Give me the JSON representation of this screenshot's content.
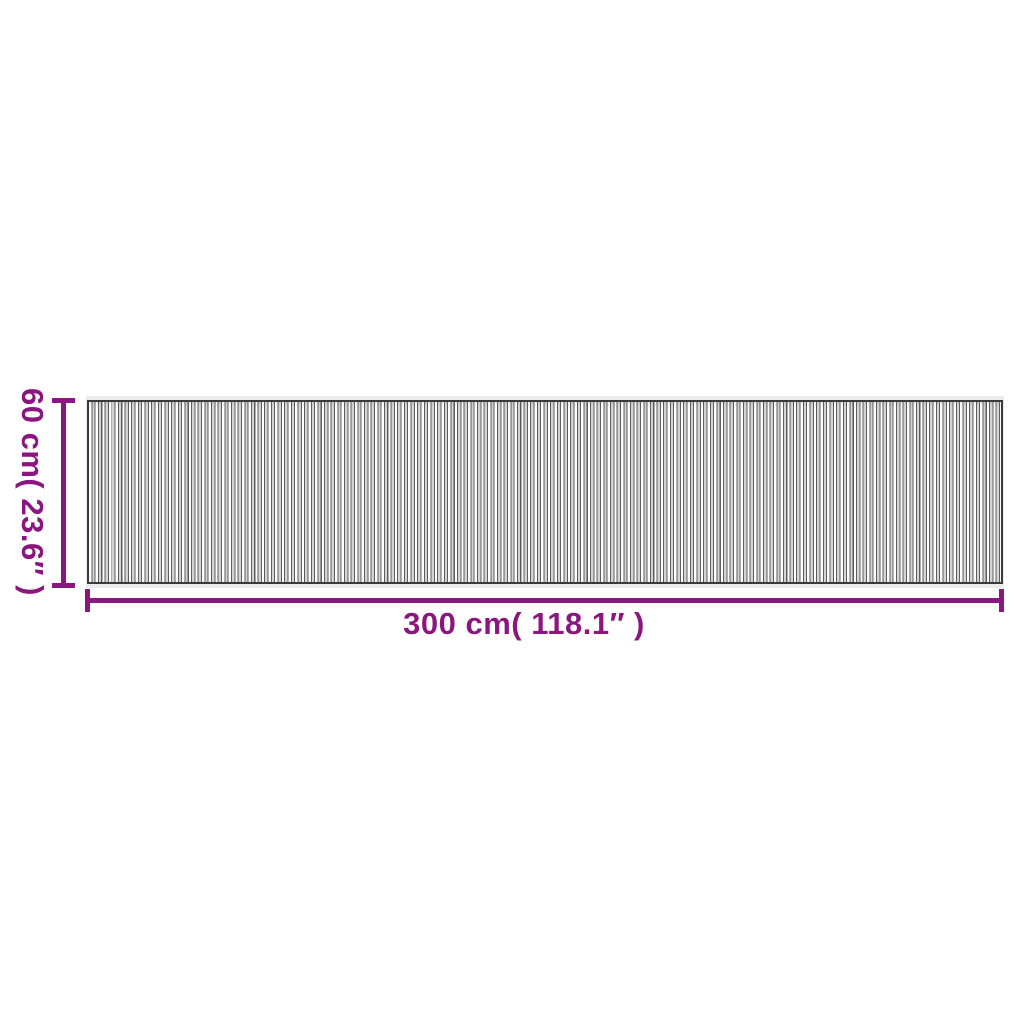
{
  "diagram": {
    "kind": "product-dimension-diagram",
    "subject": "striped-slat-rug-top-view",
    "dimensions": {
      "height": {
        "label": "60 cm( 23.6″ )"
      },
      "width": {
        "label": "300 cm( 118.1″ )"
      }
    },
    "colors": {
      "accent": "#8B1680",
      "background": "#FFFFFF",
      "edge_band": "#EBEBEB",
      "border": "#3A3A3A",
      "slat_edge": "#5E5E5E",
      "slat_face": "#D4D4D4"
    }
  }
}
